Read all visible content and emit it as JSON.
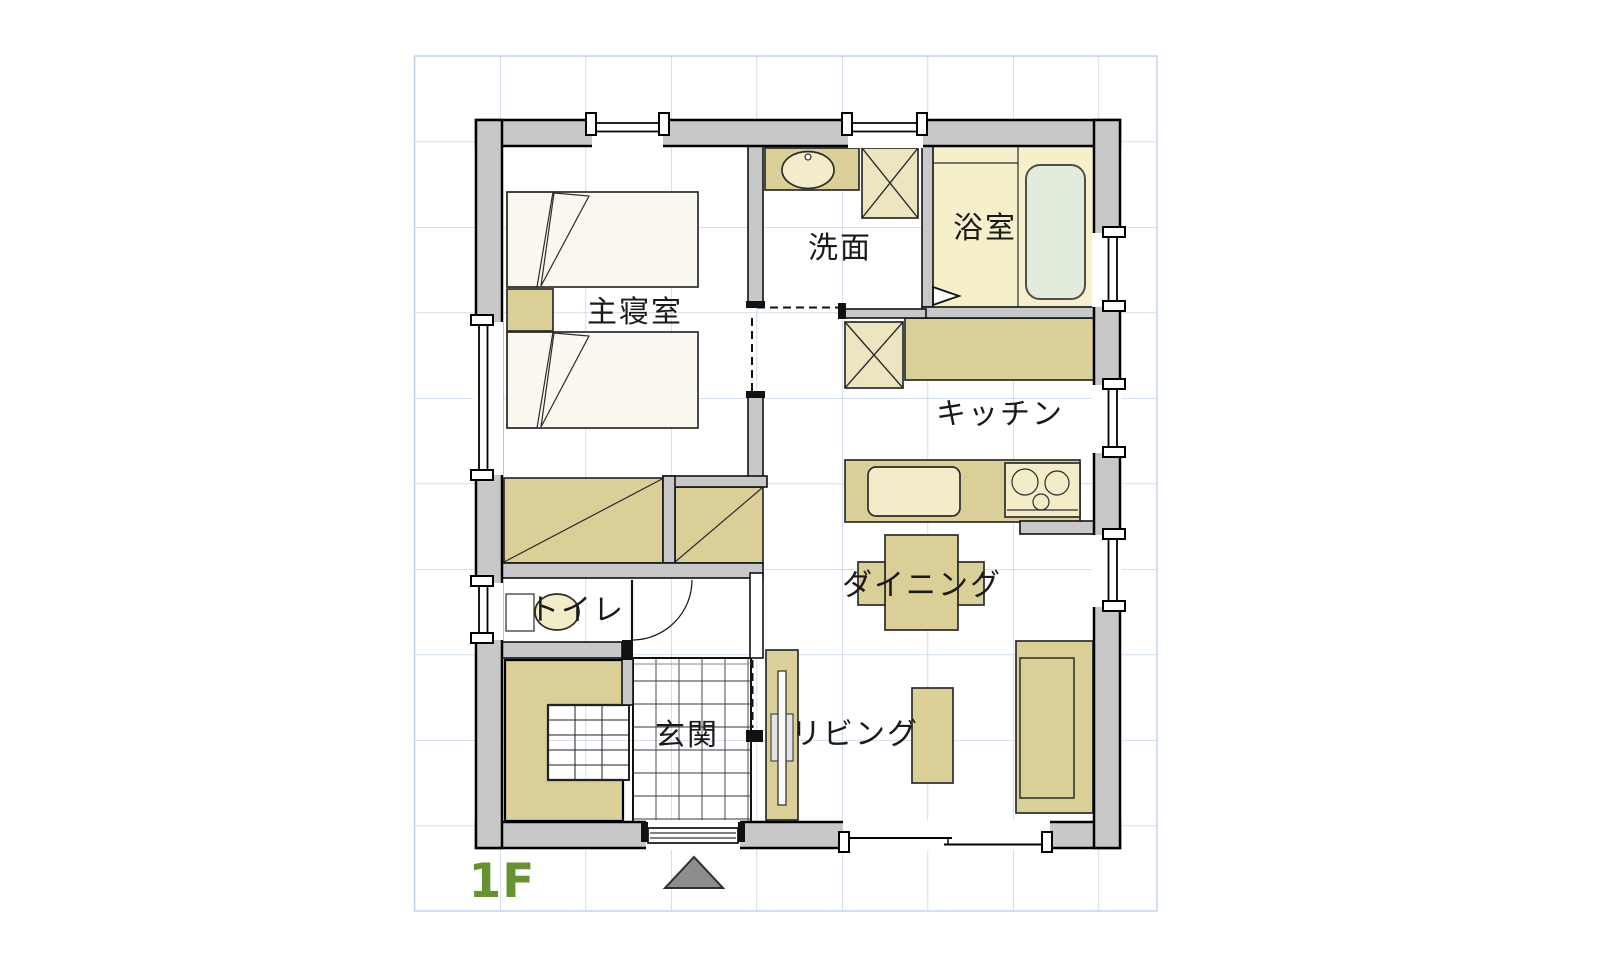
{
  "floor_plan": {
    "floor_label": "1F",
    "rooms": {
      "master_bedroom": {
        "label": "主寝室"
      },
      "washroom": {
        "label": "洗面"
      },
      "bathroom": {
        "label": "浴室"
      },
      "kitchen": {
        "label": "キッチン"
      },
      "dining": {
        "label": "ダイニング"
      },
      "living": {
        "label": "リビング"
      },
      "toilet": {
        "label": "トイレ"
      },
      "entrance": {
        "label": "玄関"
      }
    },
    "symbols": {
      "entry_arrow": "up-triangle-entry-marker"
    },
    "colors": {
      "wall_gray": "#c8c8c8",
      "furniture_tan": "#dbcf98",
      "fixture_cream": "#f3ecc8",
      "box_cream": "#ece5c0",
      "bathroom_floor": "#f5f0ca",
      "bathtub_green": "#e1ecdb",
      "bed_white": "#faf7ee",
      "grid_blue": "#b9cfe9",
      "floor_label_green": "#66922f",
      "arrow_gray": "#8d8d8d"
    }
  }
}
